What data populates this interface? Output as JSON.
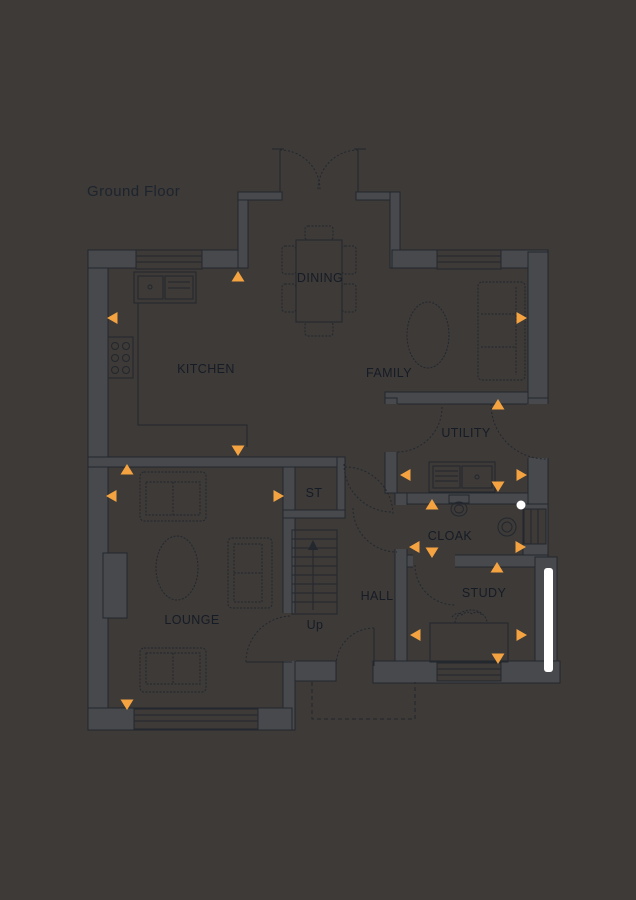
{
  "title": "Ground Floor",
  "colors": {
    "background": "#3D3A38",
    "wall_fill": "#47494C",
    "line": "#23272E",
    "text": "#1D242E",
    "marker_orange": "#F4A340",
    "highlight_white": "#FFFFFF"
  },
  "floor_plan": {
    "labels": [
      {
        "key": "kitchen",
        "text": "KITCHEN",
        "x": 206,
        "y": 373
      },
      {
        "key": "dining",
        "text": "DINING",
        "x": 320,
        "y": 282
      },
      {
        "key": "family",
        "text": "FAMILY",
        "x": 389,
        "y": 377
      },
      {
        "key": "utility",
        "text": "UTILITY",
        "x": 466,
        "y": 437
      },
      {
        "key": "st",
        "text": "ST",
        "x": 314,
        "y": 497
      },
      {
        "key": "cloak",
        "text": "CLOAK",
        "x": 450,
        "y": 540
      },
      {
        "key": "hall",
        "text": "HALL",
        "x": 377,
        "y": 600
      },
      {
        "key": "study",
        "text": "STUDY",
        "x": 484,
        "y": 597
      },
      {
        "key": "lounge",
        "text": "LOUNGE",
        "x": 192,
        "y": 624
      },
      {
        "key": "stairs-up",
        "text": "Up",
        "x": 315,
        "y": 629
      }
    ],
    "markers": [
      {
        "room": "kitchen",
        "direction": "up",
        "x": 238,
        "y": 277
      },
      {
        "room": "kitchen",
        "direction": "left",
        "x": 113,
        "y": 318
      },
      {
        "room": "family",
        "direction": "right",
        "x": 521,
        "y": 318
      },
      {
        "room": "kitchen",
        "direction": "down",
        "x": 238,
        "y": 450
      },
      {
        "room": "utility",
        "direction": "up",
        "x": 498,
        "y": 405
      },
      {
        "room": "utility",
        "direction": "left",
        "x": 406,
        "y": 475
      },
      {
        "room": "utility",
        "direction": "right",
        "x": 521,
        "y": 475
      },
      {
        "room": "utility",
        "direction": "down",
        "x": 498,
        "y": 486
      },
      {
        "room": "lounge",
        "direction": "up",
        "x": 127,
        "y": 470
      },
      {
        "room": "lounge",
        "direction": "left",
        "x": 112,
        "y": 496
      },
      {
        "room": "lounge",
        "direction": "right",
        "x": 278,
        "y": 496
      },
      {
        "room": "lounge",
        "direction": "down",
        "x": 127,
        "y": 704
      },
      {
        "room": "cloak",
        "direction": "up",
        "x": 432,
        "y": 505
      },
      {
        "room": "cloak",
        "direction": "left",
        "x": 415,
        "y": 547
      },
      {
        "room": "cloak",
        "direction": "right",
        "x": 520,
        "y": 547
      },
      {
        "room": "cloak",
        "direction": "down",
        "x": 432,
        "y": 552
      },
      {
        "room": "study",
        "direction": "up",
        "x": 497,
        "y": 568
      },
      {
        "room": "study",
        "direction": "left",
        "x": 416,
        "y": 635
      },
      {
        "room": "study",
        "direction": "right",
        "x": 521,
        "y": 635
      },
      {
        "room": "study",
        "direction": "down",
        "x": 498,
        "y": 658
      }
    ],
    "indicators": {
      "door_marker_dot": {
        "x": 521,
        "y": 505
      },
      "highlighted_window": {
        "x": 544,
        "y": 568,
        "width": 9,
        "height": 104,
        "room": "study"
      }
    }
  }
}
